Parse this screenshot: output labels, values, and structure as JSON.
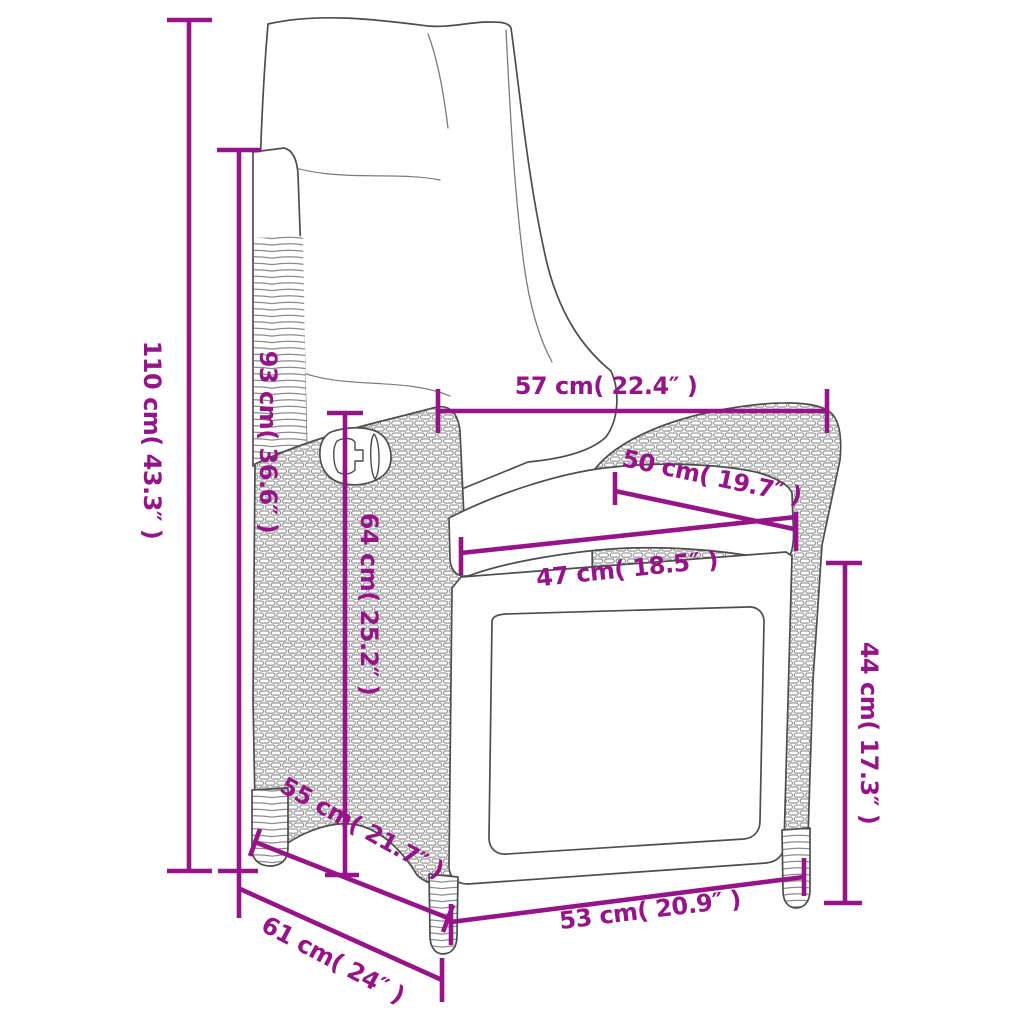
{
  "diagram": {
    "kind": "product-dimension-drawing",
    "subject": "reclining poly rattan garden chair with cushions",
    "accent_color": "#97138A",
    "art_line_color": "#4d4d4d",
    "background_color": "#ffffff",
    "units": [
      "cm",
      "inches"
    ],
    "dimensions": [
      {
        "name": "total-height",
        "label": "110 cm( 43.3″ )",
        "cm": "110",
        "inches": "43.3",
        "orientation": "vertical"
      },
      {
        "name": "backrest-height",
        "label": "93 cm( 36.6″ )",
        "cm": "93",
        "inches": "36.6",
        "orientation": "vertical"
      },
      {
        "name": "width-top",
        "label": "57 cm( 22.4″ )",
        "cm": "57",
        "inches": "22.4",
        "orientation": "horizontal"
      },
      {
        "name": "armrest-length",
        "label": "50 cm( 19.7″ )",
        "cm": "50",
        "inches": "19.7",
        "orientation": "diagonal"
      },
      {
        "name": "seat-width",
        "label": "47 cm( 18.5″ )",
        "cm": "47",
        "inches": "18.5",
        "orientation": "horizontal"
      },
      {
        "name": "side-panel-height",
        "label": "64 cm( 25.2″ )",
        "cm": "64",
        "inches": "25.2",
        "orientation": "vertical"
      },
      {
        "name": "seat-depth",
        "label": "55 cm( 21.7″ )",
        "cm": "55",
        "inches": "21.7",
        "orientation": "diagonal"
      },
      {
        "name": "base-depth",
        "label": "61 cm( 24″ )",
        "cm": "61",
        "inches": "24",
        "orientation": "diagonal"
      },
      {
        "name": "base-width",
        "label": "53 cm( 20.9″ )",
        "cm": "53",
        "inches": "20.9",
        "orientation": "horizontal"
      },
      {
        "name": "armrest-height",
        "label": "44 cm( 17.3″ )",
        "cm": "44",
        "inches": "17.3",
        "orientation": "vertical"
      }
    ]
  }
}
